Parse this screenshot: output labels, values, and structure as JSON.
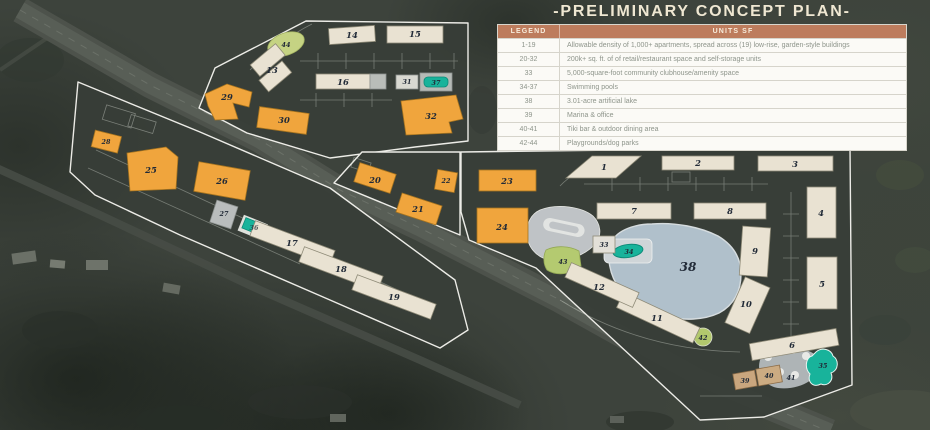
{
  "title": "-PRELIMINARY CONCEPT PLAN-",
  "legend": {
    "header": {
      "col1": "LEGEND",
      "col2": "UNITS SF"
    },
    "rows": [
      {
        "range": "1-19",
        "desc": "Allowable density of 1,000+ apartments, spread across (19) low-rise, garden-style buildings"
      },
      {
        "range": "20-32",
        "desc": "200k+ sq. ft. of of retail/restaurant space and self-storage units"
      },
      {
        "range": "33",
        "desc": "5,000-square-foot community clubhouse/amenity space"
      },
      {
        "range": "34-37",
        "desc": "Swimming pools"
      },
      {
        "range": "38",
        "desc": "3.01-acre artificial lake"
      },
      {
        "range": "39",
        "desc": "Marina & office"
      },
      {
        "range": "40-41",
        "desc": "Tiki bar & outdoor dining area"
      },
      {
        "range": "42-44",
        "desc": "Playgrounds/dog parks"
      }
    ]
  },
  "map": {
    "colors": {
      "apartment_building": "#e9e2d2",
      "retail_building": "#f0a53d",
      "storage_gray": "#c2c6c4",
      "pool_teal": "#18b39b",
      "lake_blue": "#b7c8d3",
      "park_green": "#b4ca70",
      "marina_tan": "#cbaa80",
      "parcel_outline": "#f4f3ee",
      "legend_header": "#bd7c5d"
    },
    "labels": {
      "b1": "1",
      "b2": "2",
      "b3": "3",
      "b4": "4",
      "b5": "5",
      "b6": "6",
      "b7": "7",
      "b8": "8",
      "b9": "9",
      "b10": "10",
      "b11": "11",
      "b12": "12",
      "b13": "13",
      "b14": "14",
      "b15": "15",
      "b16": "16",
      "b17": "17",
      "b18": "18",
      "b19": "19",
      "b20": "20",
      "b21": "21",
      "b22": "22",
      "b23": "23",
      "b24": "24",
      "b25": "25",
      "b26": "26",
      "b27": "27",
      "b28": "28",
      "b29": "29",
      "b30": "30",
      "b31": "31",
      "b32": "32",
      "b33": "33",
      "b34": "34",
      "b35": "35",
      "b36": "36",
      "b37": "37",
      "b38": "38",
      "b39": "39",
      "b40": "40",
      "b41": "41",
      "b42": "42",
      "b43": "43",
      "b44": "44"
    }
  }
}
